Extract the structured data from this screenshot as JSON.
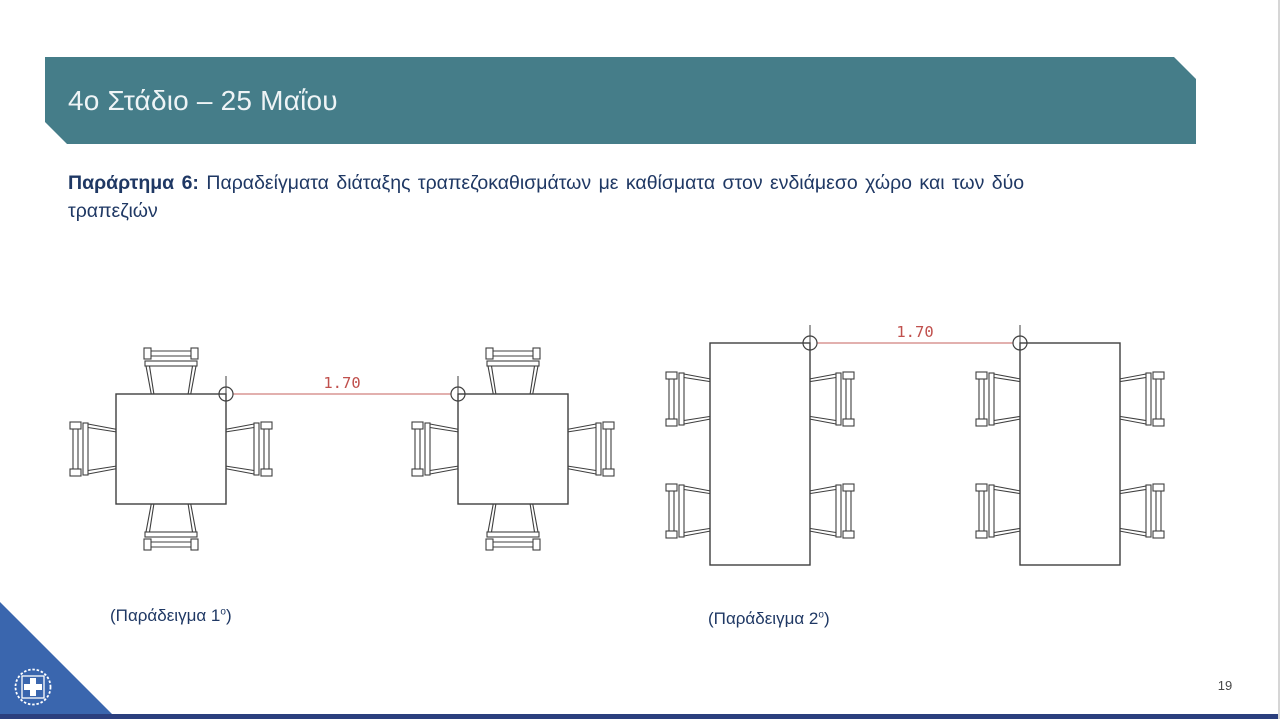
{
  "slide": {
    "title": "4ο Στάδιο – 25 Μαΐου",
    "page_number": "19"
  },
  "subtitle": {
    "bold": "Παράρτημα 6:",
    "line1_rest": " Παραδείγματα διάταξης τραπεζοκαθισμάτων με καθίσματα στον ενδιάμεσο χώρο και των δύο",
    "line2": "τραπεζιών"
  },
  "diagrams": {
    "example1": {
      "dimension_label": "1.70",
      "caption_open": "(Παράδειγμα 1",
      "caption_sup": "ο",
      "caption_close": ")",
      "table_shape": "square",
      "tables": 2,
      "chairs_per_table": 4,
      "dimension_meaning": "distance between tables in meters"
    },
    "example2": {
      "dimension_label": "1.70",
      "caption_open": "(Παράδειγμα 2",
      "caption_sup": "ο",
      "caption_close": ")",
      "table_shape": "rectangular",
      "tables": 2,
      "chairs_per_table": 4,
      "dimension_meaning": "distance between tables in meters"
    }
  },
  "colors": {
    "banner": "#457d89",
    "banner_text": "#eef4f6",
    "body_text": "#1f3864",
    "dimension_line": "#d99694",
    "dimension_text": "#c0504d",
    "drawing_stroke": "#3f3f3f",
    "logo_blue": "#3a66ae",
    "footer_bar": "#2b3f7e",
    "page_number_text": "#484848"
  }
}
